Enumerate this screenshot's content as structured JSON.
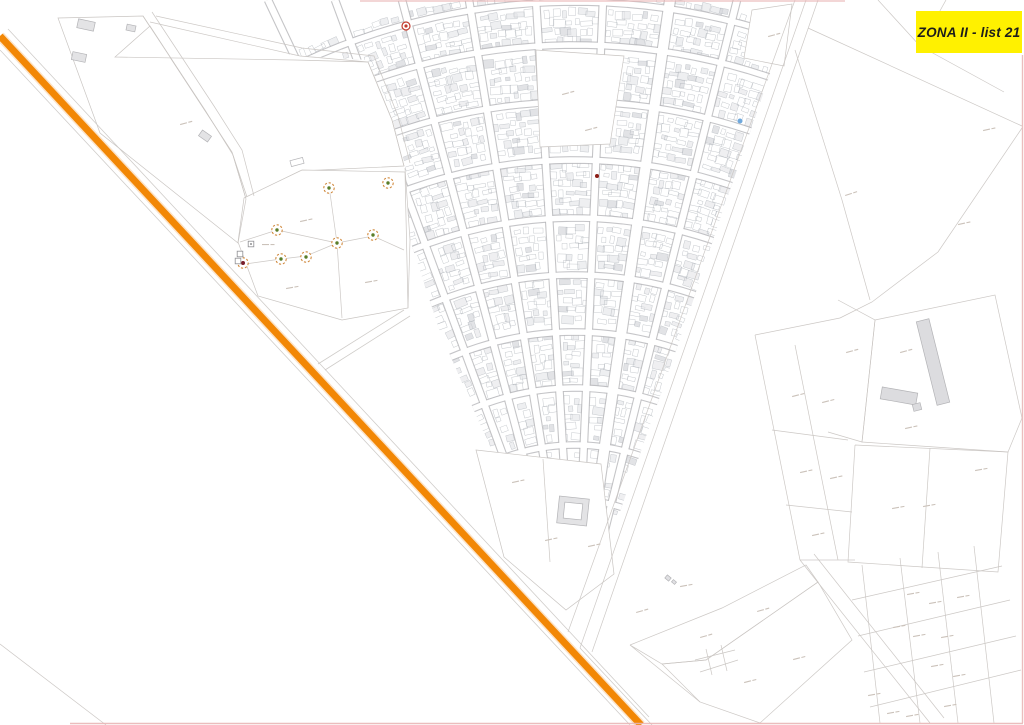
{
  "title_label": {
    "text": "ZONA II - list 21",
    "bg": "#FFF100",
    "fg": "#1d1d1b"
  },
  "canvas": {
    "w": 1024,
    "h": 725,
    "bg": "#ffffff"
  },
  "palette": {
    "parcel_line": "#c9c5c2",
    "street_edge": "#b7b7ba",
    "building_stroke": "#9ba1a9",
    "building_fill": "#e4e5e8",
    "building_fill_dark": "#cfd1d6",
    "label_dash": "#cbc2ba",
    "frame_pink": "#e9b6b6",
    "route_orange": "#F28705",
    "route_halo": "#f6b066"
  },
  "fan": {
    "focus": [
      575,
      650
    ],
    "street_tops": [
      268,
      335,
      402,
      469,
      536,
      603,
      670,
      737
    ],
    "street_widths": [
      6.5,
      6.5,
      6.5,
      6.5,
      6.5,
      6.5,
      10,
      6.5
    ],
    "cross_radii": [
      95,
      150,
      205,
      262,
      318,
      375,
      432,
      490,
      548,
      605,
      648
    ],
    "cross_width": 5.5,
    "angle_min": -0.54,
    "angle_max": 0.35,
    "rng_seed": 42,
    "step_r": 9
  },
  "wedge": [
    [
      205,
      0
    ],
    [
      795,
      0
    ],
    [
      756,
      115
    ],
    [
      723,
      210
    ],
    [
      690,
      310
    ],
    [
      657,
      405
    ],
    [
      624,
      500
    ],
    [
      595,
      585
    ],
    [
      568,
      632
    ],
    [
      545,
      572
    ],
    [
      520,
      520
    ],
    [
      492,
      452
    ],
    [
      466,
      392
    ],
    [
      440,
      332
    ],
    [
      410,
      240
    ],
    [
      405,
      165
    ],
    [
      392,
      118
    ],
    [
      368,
      60
    ],
    [
      300,
      56
    ],
    [
      250,
      48
    ],
    [
      215,
      28
    ]
  ],
  "carves": [
    {
      "name": "parcel-top-left",
      "pts": [
        [
          58,
          18
        ],
        [
          143,
          16
        ],
        [
          232,
          152
        ],
        [
          246,
          199
        ],
        [
          238,
          243
        ],
        [
          100,
          133
        ]
      ]
    },
    {
      "name": "parcel-large-left",
      "pts": [
        [
          115,
          57
        ],
        [
          295,
          60
        ],
        [
          368,
          62
        ],
        [
          392,
          120
        ],
        [
          404,
          166
        ],
        [
          300,
          171
        ],
        [
          247,
          197
        ],
        [
          232,
          152
        ],
        [
          150,
          26
        ]
      ]
    },
    {
      "name": "parcel-markers",
      "pts": [
        [
          244,
          198
        ],
        [
          302,
          170
        ],
        [
          405,
          172
        ],
        [
          408,
          308
        ],
        [
          342,
          320
        ],
        [
          258,
          296
        ],
        [
          238,
          242
        ]
      ]
    },
    {
      "name": "parcel-central-block",
      "pts": [
        [
          536,
          50
        ],
        [
          624,
          56
        ],
        [
          610,
          144
        ],
        [
          540,
          147
        ]
      ]
    },
    {
      "name": "parcel-right-notch",
      "pts": [
        [
          752,
          10
        ],
        [
          792,
          4
        ],
        [
          784,
          66
        ],
        [
          744,
          58
        ]
      ]
    },
    {
      "name": "parcel-pool-zone",
      "pts": [
        [
          476,
          450
        ],
        [
          601,
          464
        ],
        [
          614,
          574
        ],
        [
          566,
          610
        ],
        [
          504,
          557
        ]
      ]
    }
  ],
  "parcel_lines": [
    [
      [
        143,
        16
      ],
      [
        205,
        110
      ],
      [
        233,
        155
      ],
      [
        246,
        199
      ],
      [
        238,
        243
      ]
    ],
    [
      [
        152,
        12
      ],
      [
        214,
        106
      ],
      [
        242,
        150
      ],
      [
        254,
        196
      ]
    ],
    [
      [
        150,
        22
      ],
      [
        300,
        56
      ],
      [
        368,
        62
      ],
      [
        392,
        120
      ],
      [
        404,
        166
      ]
    ],
    [
      [
        156,
        16
      ],
      [
        302,
        48
      ],
      [
        374,
        56
      ],
      [
        398,
        116
      ],
      [
        410,
        163
      ]
    ],
    [
      [
        806,
        0
      ],
      [
        580,
        648
      ]
    ],
    [
      [
        818,
        0
      ],
      [
        592,
        652
      ]
    ],
    [
      [
        808,
        28
      ],
      [
        1022,
        126
      ]
    ],
    [
      [
        1022,
        128
      ],
      [
        938,
        252
      ],
      [
        872,
        302
      ],
      [
        840,
        318
      ]
    ],
    [
      [
        795,
        50
      ],
      [
        842,
        200
      ],
      [
        870,
        300
      ]
    ],
    [
      [
        875,
        320
      ],
      [
        995,
        295
      ],
      [
        1022,
        418
      ],
      [
        1008,
        452
      ],
      [
        862,
        442
      ],
      [
        875,
        320
      ]
    ],
    [
      [
        838,
        300
      ],
      [
        875,
        320
      ],
      [
        862,
        442
      ],
      [
        828,
        432
      ]
    ],
    [
      [
        855,
        445
      ],
      [
        1008,
        452
      ],
      [
        998,
        572
      ],
      [
        848,
        562
      ],
      [
        855,
        445
      ]
    ],
    [
      [
        930,
        448
      ],
      [
        922,
        568
      ]
    ],
    [
      [
        755,
        335
      ],
      [
        800,
        560
      ]
    ],
    [
      [
        795,
        345
      ],
      [
        838,
        560
      ]
    ],
    [
      [
        755,
        335
      ],
      [
        840,
        318
      ]
    ],
    [
      [
        772,
        430
      ],
      [
        848,
        440
      ]
    ],
    [
      [
        786,
        505
      ],
      [
        852,
        512
      ]
    ],
    [
      [
        800,
        560
      ],
      [
        855,
        560
      ]
    ],
    [
      [
        800,
        560
      ],
      [
        930,
        723
      ]
    ],
    [
      [
        814,
        554
      ],
      [
        944,
        718
      ]
    ],
    [
      [
        862,
        565
      ],
      [
        880,
        723
      ]
    ],
    [
      [
        900,
        558
      ],
      [
        920,
        723
      ]
    ],
    [
      [
        938,
        552
      ],
      [
        958,
        723
      ]
    ],
    [
      [
        974,
        546
      ],
      [
        994,
        723
      ]
    ],
    [
      [
        852,
        600
      ],
      [
        1002,
        566
      ]
    ],
    [
      [
        858,
        636
      ],
      [
        1010,
        600
      ]
    ],
    [
      [
        864,
        672
      ],
      [
        1016,
        636
      ]
    ],
    [
      [
        870,
        707
      ],
      [
        1021,
        670
      ]
    ],
    [
      [
        630,
        645
      ],
      [
        722,
        608
      ],
      [
        806,
        565
      ],
      [
        818,
        582
      ],
      [
        706,
        660
      ],
      [
        662,
        664
      ],
      [
        630,
        645
      ]
    ],
    [
      [
        662,
        664
      ],
      [
        706,
        660
      ],
      [
        818,
        582
      ],
      [
        852,
        640
      ],
      [
        760,
        723
      ],
      [
        700,
        702
      ],
      [
        662,
        664
      ]
    ],
    [
      [
        695,
        660
      ],
      [
        735,
        650
      ]
    ],
    [
      [
        700,
        672
      ],
      [
        738,
        660
      ]
    ],
    [
      [
        706,
        649
      ],
      [
        712,
        675
      ]
    ],
    [
      [
        721,
        645
      ],
      [
        727,
        671
      ]
    ],
    [
      [
        630,
        645
      ],
      [
        700,
        702
      ]
    ],
    [
      [
        580,
        648
      ],
      [
        652,
        725
      ]
    ],
    [
      [
        878,
        0
      ],
      [
        920,
        46
      ],
      [
        1004,
        92
      ]
    ],
    [
      [
        946,
        0
      ],
      [
        921,
        45
      ]
    ],
    [
      [
        0,
        644
      ],
      [
        106,
        725
      ]
    ],
    [
      [
        329,
        186
      ],
      [
        337,
        243
      ],
      [
        342,
        318
      ]
    ],
    [
      [
        238,
        265
      ],
      [
        281,
        259
      ],
      [
        306,
        256
      ],
      [
        337,
        243
      ],
      [
        373,
        236
      ],
      [
        404,
        250
      ]
    ],
    [
      [
        277,
        230
      ],
      [
        337,
        243
      ]
    ],
    [
      [
        240,
        242
      ],
      [
        277,
        230
      ]
    ],
    [
      [
        405,
        168
      ],
      [
        410,
        240
      ],
      [
        408,
        308
      ]
    ],
    [
      [
        795,
        0
      ],
      [
        568,
        632
      ]
    ],
    [
      [
        543,
        459
      ],
      [
        550,
        562
      ]
    ]
  ],
  "flanks": [
    [
      [
        8,
        29
      ],
      [
        649,
        717
      ]
    ],
    [
      [
        0,
        50
      ],
      [
        630,
        725
      ]
    ],
    [
      [
        318,
        364
      ],
      [
        404,
        310
      ]
    ],
    [
      [
        325,
        370
      ],
      [
        410,
        316
      ]
    ]
  ],
  "route": {
    "from": [
      0,
      36
    ],
    "to": [
      641,
      725
    ]
  },
  "frame": {
    "top": [
      [
        360,
        1
      ],
      [
        845,
        1
      ]
    ],
    "right": [
      [
        1022.5,
        55
      ],
      [
        1022.5,
        723
      ]
    ],
    "bottom": [
      [
        70,
        723.5
      ],
      [
        1023,
        723.5
      ]
    ]
  },
  "structures": [
    {
      "x": 86,
      "y": 25,
      "w": 17,
      "h": 9,
      "rot": 12,
      "fill": "#e3e3e5"
    },
    {
      "x": 79,
      "y": 57,
      "w": 14,
      "h": 8,
      "rot": 12,
      "fill": "#e3e3e5"
    },
    {
      "x": 131,
      "y": 28,
      "w": 9,
      "h": 6,
      "rot": 12,
      "fill": "#e3e3e5"
    },
    {
      "x": 205,
      "y": 136,
      "w": 11,
      "h": 7,
      "rot": 35,
      "fill": "#e3e3e5"
    },
    {
      "x": 297,
      "y": 162,
      "w": 13,
      "h": 6,
      "rot": -15,
      "fill": "none"
    },
    {
      "x": 573,
      "y": 511,
      "w": 30,
      "h": 27,
      "rot": 6,
      "fill": "#e3e3e5"
    },
    {
      "x": 573,
      "y": 511,
      "w": 18,
      "h": 16,
      "rot": 6,
      "fill": "#ffffff"
    },
    {
      "x": 933,
      "y": 362,
      "w": 13,
      "h": 86,
      "rot": -14,
      "fill": "#dcdcdf"
    },
    {
      "x": 899,
      "y": 396,
      "w": 36,
      "h": 12,
      "rot": 10,
      "fill": "#dcdcdf"
    },
    {
      "x": 917,
      "y": 407,
      "w": 8,
      "h": 7,
      "rot": -14,
      "fill": "#dcdcdf"
    },
    {
      "x": 668,
      "y": 578,
      "w": 5,
      "h": 4,
      "rot": 40,
      "fill": "#e0e0e3"
    },
    {
      "x": 674,
      "y": 582,
      "w": 4,
      "h": 3,
      "rot": 40,
      "fill": "#e0e0e3"
    }
  ],
  "labels": [
    [
      180,
      124,
      -15
    ],
    [
      300,
      221,
      -12
    ],
    [
      286,
      288,
      -10
    ],
    [
      365,
      282,
      -10
    ],
    [
      562,
      94,
      -15
    ],
    [
      585,
      130,
      -15
    ],
    [
      545,
      540,
      -12
    ],
    [
      512,
      482,
      -12
    ],
    [
      588,
      546,
      -12
    ],
    [
      768,
      36,
      -15
    ],
    [
      845,
      195,
      -18
    ],
    [
      900,
      352,
      -15
    ],
    [
      846,
      352,
      -15
    ],
    [
      983,
      130,
      -12
    ],
    [
      958,
      224,
      -12
    ],
    [
      923,
      506,
      -10
    ],
    [
      892,
      508,
      -10
    ],
    [
      792,
      396,
      -14
    ],
    [
      822,
      402,
      -14
    ],
    [
      800,
      472,
      -12
    ],
    [
      830,
      478,
      -12
    ],
    [
      812,
      535,
      -12
    ],
    [
      700,
      637,
      -16
    ],
    [
      757,
      611,
      -16
    ],
    [
      744,
      682,
      -14
    ],
    [
      793,
      659,
      -14
    ],
    [
      636,
      612,
      -16
    ],
    [
      907,
      594,
      -10
    ],
    [
      929,
      603,
      -10
    ],
    [
      893,
      627,
      -10
    ],
    [
      913,
      636,
      -10
    ],
    [
      931,
      666,
      -10
    ],
    [
      868,
      695,
      -10
    ],
    [
      887,
      713,
      -10
    ],
    [
      906,
      716,
      -10
    ],
    [
      944,
      706,
      -10
    ],
    [
      953,
      676,
      -10
    ],
    [
      941,
      637,
      -10
    ],
    [
      957,
      597,
      -10
    ],
    [
      680,
      586,
      -10
    ],
    [
      905,
      428,
      -12
    ],
    [
      975,
      470,
      -10
    ],
    [
      262,
      244,
      0
    ]
  ],
  "markers": {
    "geodetic_green": {
      "ring": "#d0893d",
      "dot": "#5a7d2a",
      "points": [
        [
          329,
          188
        ],
        [
          388,
          183
        ],
        [
          277,
          230
        ],
        [
          373,
          235
        ],
        [
          337,
          243
        ],
        [
          281,
          259
        ],
        [
          306,
          257
        ]
      ]
    },
    "geodetic_red": {
      "ring": "#d0893d",
      "dot": "#7a1f2b",
      "points": [
        [
          243,
          263
        ]
      ]
    },
    "red_ring": {
      "color": "#c23b2d",
      "points": [
        [
          406,
          26
        ]
      ]
    },
    "red_dot": {
      "color": "#8b1d15",
      "points": [
        [
          597,
          176
        ]
      ]
    },
    "blue_dot": {
      "color": "#6fa8dc",
      "points": [
        [
          740,
          121
        ]
      ]
    },
    "squares": {
      "stroke": "#8f8f93",
      "dot": "#6f6f73",
      "points": [
        [
          251,
          244
        ],
        [
          240,
          254
        ],
        [
          238,
          261
        ]
      ]
    }
  }
}
